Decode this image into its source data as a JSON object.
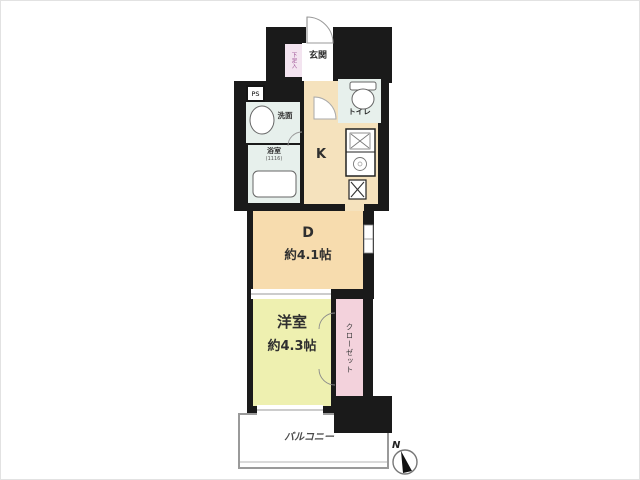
{
  "floor_plan": {
    "rooms": {
      "entrance": {
        "label": "玄関"
      },
      "shoe_storage": {
        "label": "下足入"
      },
      "pipe_space": {
        "label": "PS"
      },
      "washroom": {
        "label": "洗面"
      },
      "toilet": {
        "label": "トイレ"
      },
      "bathroom": {
        "label": "浴室",
        "size": "(1116)"
      },
      "kitchen": {
        "label": "K"
      },
      "dining": {
        "label": "D",
        "size": "約4.1帖"
      },
      "western_room": {
        "label": "洋室",
        "size": "約4.3帖"
      },
      "closet": {
        "label": "クローゼット"
      },
      "balcony": {
        "label": "バルコニー"
      }
    },
    "compass": {
      "north_label": "N"
    },
    "icons": [
      "entrance-door-arc-icon",
      "interior-door-arc-icon",
      "bathroom-door-arc-icon",
      "washbasin-icon",
      "toilet-icon",
      "bathtub-icon",
      "kitchen-sink-icon",
      "stove-icon",
      "washing-machine-icon",
      "window-icon",
      "sliding-door-icon",
      "closet-door-arc-icon",
      "compass-icon"
    ],
    "colors": {
      "wall": "#1a1a1a",
      "kitchen_hall_floor": "#f5e2bd",
      "dining_floor": "#f7dcae",
      "western_room_floor": "#eef0b0",
      "closet_floor": "#f3d2dc",
      "wet_area_floor": "#e7f0ec",
      "shoe_storage_floor": "#f3e4f0",
      "shoe_storage_text": "#9a4d92",
      "balcony_outline": "#9a9a9a"
    }
  }
}
